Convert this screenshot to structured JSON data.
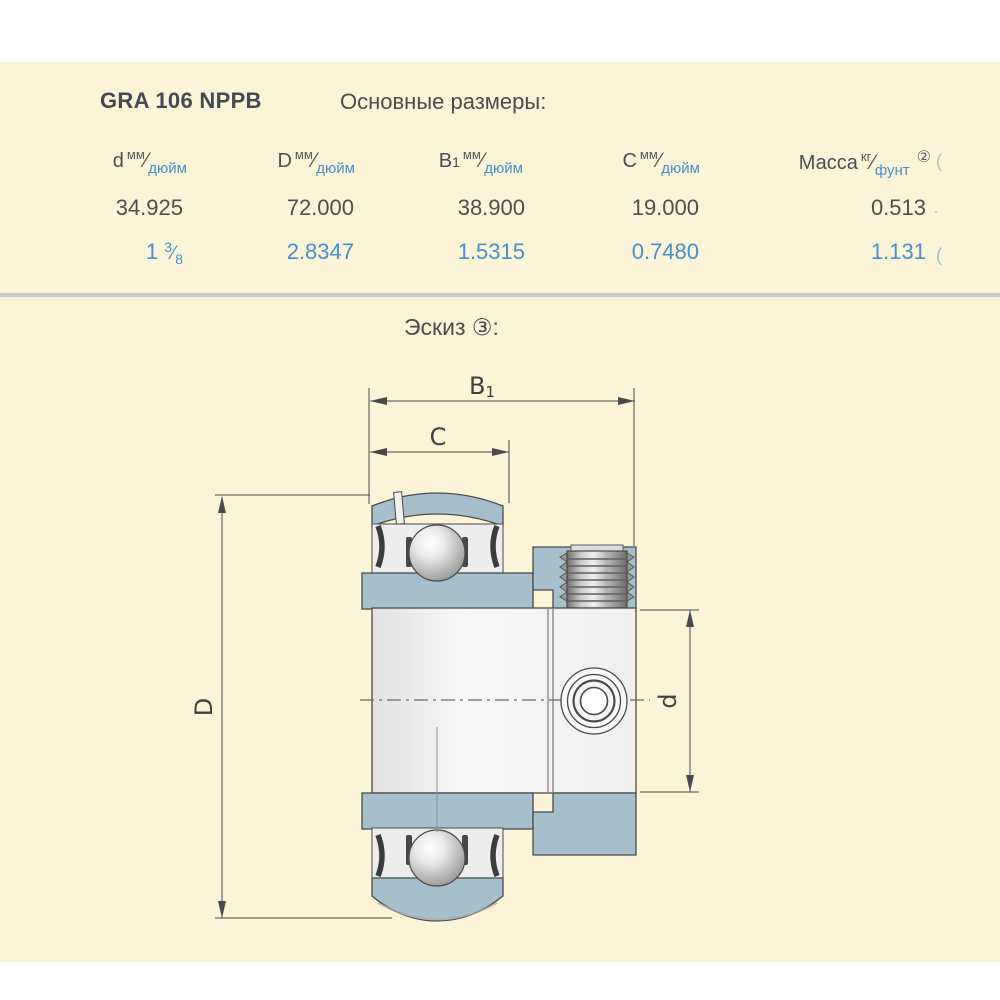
{
  "page": {
    "background": "#ffffff",
    "panel_background": "#FBF4D6"
  },
  "header": {
    "model": "GRA 106 NPPB",
    "section_title": "Основные размеры:"
  },
  "table": {
    "slash": "⁄",
    "unit_mm": "мм",
    "unit_inch": "дюйм",
    "unit_kg": "кг",
    "unit_lb": "фунт",
    "columns": [
      {
        "sym": "d",
        "sub": ""
      },
      {
        "sym": "D",
        "sub": ""
      },
      {
        "sym": "B",
        "sub": "1"
      },
      {
        "sym": "C",
        "sub": ""
      }
    ],
    "mass_label": "Масса",
    "mass_footnote": "②",
    "row_mm": [
      "34.925",
      "72.000",
      "38.900",
      "19.000",
      "0.513"
    ],
    "row_inch": [
      "2.8347",
      "1.5315",
      "0.7480",
      "1.131"
    ],
    "inch_fraction": {
      "whole": "1",
      "num": "3",
      "den": "8"
    },
    "clipped_fragments": {
      "header": "(",
      "row_mm": "·",
      "row_inch": "("
    }
  },
  "sketch": {
    "title": "Эскиз ③:",
    "labels": {
      "B": "B",
      "B_sub": "1",
      "C": "C",
      "D": "D",
      "d": "d"
    }
  },
  "colors": {
    "accent_blue": "#4690D0",
    "text_dark": "#514F4D",
    "bearing_fill": "#A6BFCD",
    "drawing_line": "#4A4A4A",
    "divider": "#C8C8C8"
  }
}
